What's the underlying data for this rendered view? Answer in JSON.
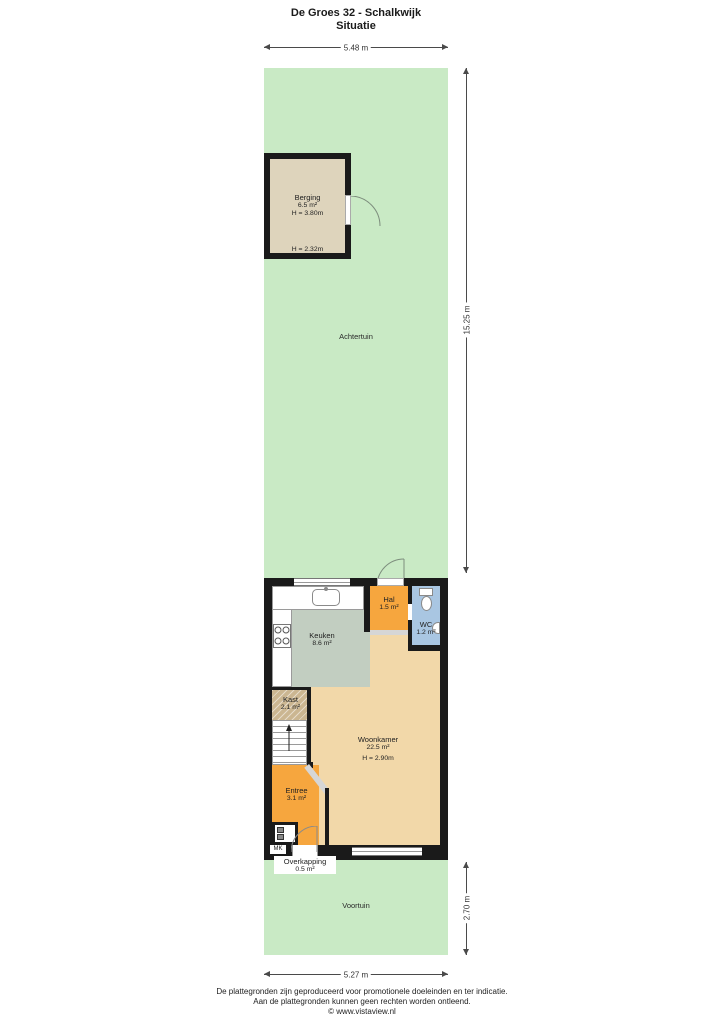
{
  "page": {
    "title": "De Groes 32 - Schalkwijk",
    "subtitle": "Situatie"
  },
  "dimensions": {
    "plot_width_top": "5.48 m",
    "garden_back_depth": "15.25 m",
    "garden_front_depth": "2.70 m",
    "house_width_bottom": "5.27 m"
  },
  "garden": {
    "back_label": "Achtertuin",
    "front_label": "Voortuin"
  },
  "rooms": {
    "berging": {
      "name": "Berging",
      "area": "6.5 m²",
      "height": "H = 3.80m",
      "height_secondary": "H = 2.32m"
    },
    "keuken": {
      "name": "Keuken",
      "area": "8.6 m²"
    },
    "hal": {
      "name": "Hal",
      "area": "1.5 m²"
    },
    "wc": {
      "name": "WC",
      "area": "1.2 m²"
    },
    "kast": {
      "name": "Kast",
      "area": "2.1 m²"
    },
    "woonkamer": {
      "name": "Woonkamer",
      "area": "22.5 m²",
      "height": "H = 2.90m"
    },
    "entree": {
      "name": "Entree",
      "area": "3.1 m²"
    },
    "meterkast": {
      "name": "MK"
    },
    "overkapping": {
      "name": "Overkapping",
      "area": "0.5 m²"
    }
  },
  "footer": {
    "line1": "De plattegronden zijn geproduceerd voor promotionele doeleinden en ter indicatie.",
    "line2": "Aan de plattegronden kunnen geen rechten worden ontleend.",
    "line3": "© www.vistaview.nl"
  },
  "colors": {
    "garden": "#c9eac5",
    "wall": "#1a1a1a",
    "berging_floor": "#ded4bc",
    "keuken_floor": "#c2cec1",
    "hal_floor": "#f6a63e",
    "wc_floor": "#a9c6e2",
    "woonkamer_floor": "#f2d8a9",
    "kast_floor": "#cbb691",
    "entree_floor": "#f6a63e"
  }
}
